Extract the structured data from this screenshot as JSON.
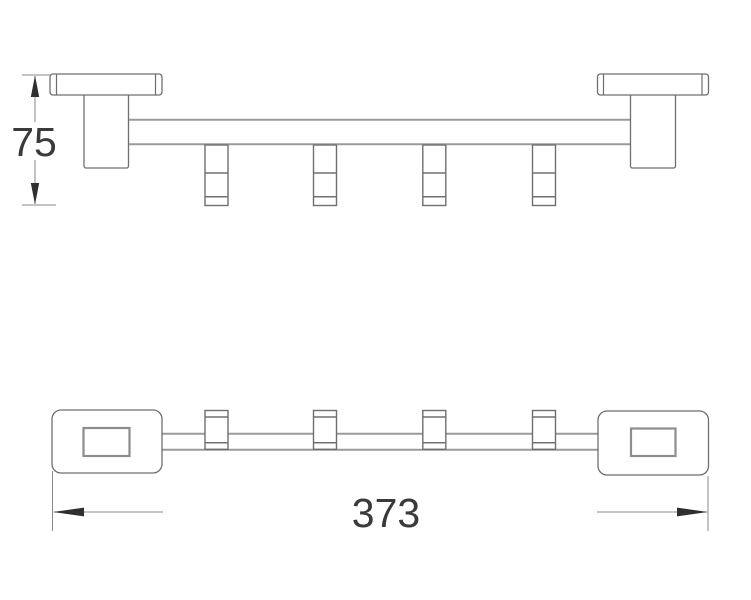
{
  "drawing": {
    "type": "technical-dimension-drawing",
    "views": {
      "front_view": {
        "hook_count": 4
      },
      "top_view": {
        "hook_count": 4
      }
    },
    "dimensions": {
      "height": {
        "value": "75",
        "orientation": "vertical"
      },
      "length": {
        "value": "373",
        "orientation": "horizontal"
      }
    },
    "colors": {
      "background": "#ffffff",
      "outline": "#6f6f6f",
      "bar_line": "#9a9a9a",
      "dimension_line": "#8a8a8a",
      "arrow": "#2f2f2f",
      "text": "#3a3a3a"
    }
  }
}
